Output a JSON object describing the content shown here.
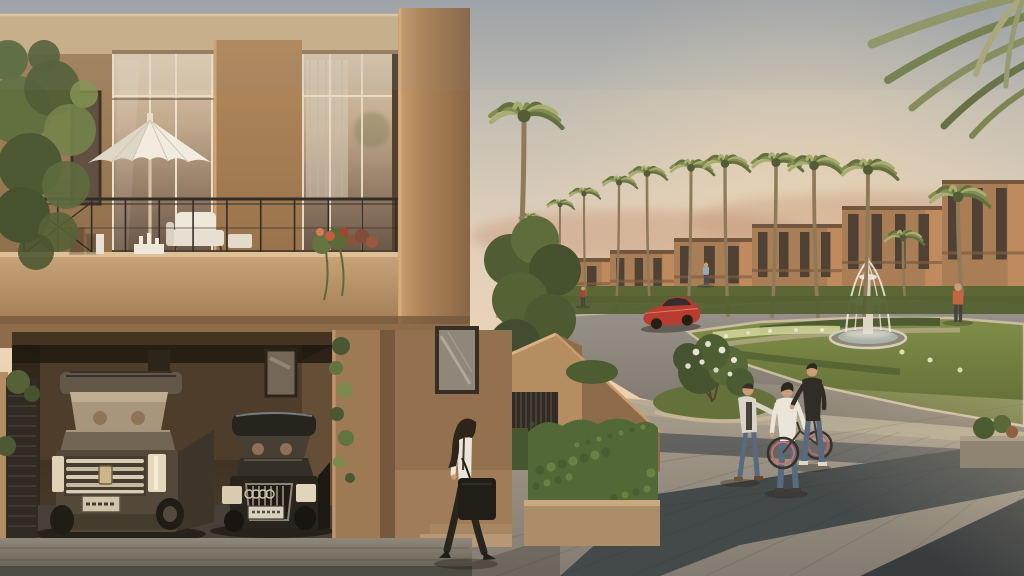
{
  "meta": {
    "description": "Photorealistic architectural rendering of a residential villa community at dusk: a two-storey stone villa with balcony, umbrella and double garage (silver SUV and black sedan) on the left; a woman with a tote bag walking past the entrance hedges; a palm-lined street with a fountain roundabout, a red sports car, and three men with a bicycle on a stone plaza to the right."
  },
  "palette": {
    "sky_top": "#9aa2aa",
    "sky_mid": "#dfd0bd",
    "sky_peach": "#ecd5b8",
    "sky_horizon": "#e0ad8a",
    "stone": "#a98159",
    "stone_light": "#cbb08c",
    "stone_dark": "#7e5f42",
    "glass_warm": "#c9b194",
    "glass_dark": "#5f4e41",
    "railing": "#2a2622",
    "umbrella": "#f2eee4",
    "foliage_dark": "#3f5129",
    "foliage": "#5d7038",
    "foliage_light": "#7e9350",
    "hedge": "#4e6631",
    "lawn": "#6f7f3e",
    "palm_frond": "#7d8a4e",
    "palm_frond_light": "#a4ac6e",
    "palm_frond_dark": "#5c6b38",
    "palm_trunk": "#8a7454",
    "asphalt": "#8b8680",
    "curb": "#c9bba1",
    "plaza": "#958e82",
    "plaza_dark": "#3a4145",
    "plaza_darker": "#2d3338",
    "fountain": "#e6dfd1",
    "water": "#f2f0e8",
    "car_red": "#b5352a",
    "suv_body": "#564a3d",
    "sedan_body": "#1b1a17",
    "chrome": "#d9cdb4",
    "skin": "#c79b78",
    "denim": "#4e647e",
    "white_cloth": "#eae6dd",
    "black_cloth": "#26231f",
    "villa_wall": "#a57a52",
    "villa_lit": "#c08a5e",
    "villa_window": "#3c322a"
  },
  "distant_villas": [
    {
      "x": 560,
      "y": 258,
      "w": 52,
      "h": 44
    },
    {
      "x": 610,
      "y": 250,
      "w": 66,
      "h": 54
    },
    {
      "x": 674,
      "y": 238,
      "w": 82,
      "h": 68
    },
    {
      "x": 752,
      "y": 224,
      "w": 94,
      "h": 82
    },
    {
      "x": 842,
      "y": 206,
      "w": 104,
      "h": 100
    },
    {
      "x": 942,
      "y": 180,
      "w": 82,
      "h": 130
    }
  ],
  "palms": [
    {
      "x": 532,
      "top": 212,
      "base": 304,
      "r": 13,
      "lean": -2
    },
    {
      "x": 558,
      "top": 198,
      "base": 307,
      "r": 15,
      "lean": 2
    },
    {
      "x": 586,
      "top": 186,
      "base": 309,
      "r": 17,
      "lean": -2
    },
    {
      "x": 616,
      "top": 174,
      "base": 311,
      "r": 19,
      "lean": 3
    },
    {
      "x": 650,
      "top": 164,
      "base": 313,
      "r": 21,
      "lean": -3
    },
    {
      "x": 688,
      "top": 157,
      "base": 315,
      "r": 24,
      "lean": 3
    },
    {
      "x": 728,
      "top": 152,
      "base": 317,
      "r": 26,
      "lean": -3
    },
    {
      "x": 772,
      "top": 150,
      "base": 318,
      "r": 28,
      "lean": 4
    },
    {
      "x": 818,
      "top": 152,
      "base": 318,
      "r": 30,
      "lean": -4
    },
    {
      "x": 864,
      "top": 156,
      "base": 317,
      "r": 31,
      "lean": 4
    },
    {
      "x": 906,
      "top": 228,
      "base": 310,
      "r": 22,
      "lean": -3
    },
    {
      "x": 963,
      "top": 182,
      "base": 306,
      "r": 33,
      "lean": -5
    },
    {
      "x": 518,
      "top": 98,
      "base": 296,
      "r": 40,
      "lean": 6
    }
  ],
  "background_people": [
    {
      "x": 583,
      "y": 306,
      "h": 19,
      "shirt": "#a83a2c",
      "pants": "#3a3a3c"
    },
    {
      "x": 706,
      "y": 285,
      "h": 22,
      "shirt": "#93a7b8",
      "pants": "#44474e"
    },
    {
      "x": 958,
      "y": 322,
      "h": 38,
      "shirt": "#c0603c",
      "pants": "#3c3a38"
    }
  ],
  "paving_joints": [
    [
      470,
      550,
      880,
      428
    ],
    [
      496,
      576,
      900,
      432
    ],
    [
      560,
      576,
      930,
      436
    ],
    [
      630,
      576,
      960,
      440
    ],
    [
      705,
      576,
      995,
      444
    ],
    [
      790,
      576,
      1020,
      450
    ],
    [
      880,
      576,
      1024,
      462
    ],
    [
      960,
      576,
      1024,
      492
    ],
    [
      610,
      470,
      1024,
      404
    ],
    [
      560,
      520,
      1024,
      458
    ]
  ],
  "railing": {
    "x1": 24,
    "x2": 396,
    "top": 199,
    "bottom": 254,
    "posts": 12
  },
  "ivy_clusters": [
    {
      "x": 341,
      "y": 346,
      "r": 9
    },
    {
      "x": 336,
      "y": 368,
      "r": 7
    },
    {
      "x": 345,
      "y": 390,
      "r": 8
    },
    {
      "x": 337,
      "y": 414,
      "r": 7
    },
    {
      "x": 346,
      "y": 438,
      "r": 8
    },
    {
      "x": 339,
      "y": 462,
      "r": 6
    },
    {
      "x": 350,
      "y": 478,
      "r": 5
    }
  ]
}
